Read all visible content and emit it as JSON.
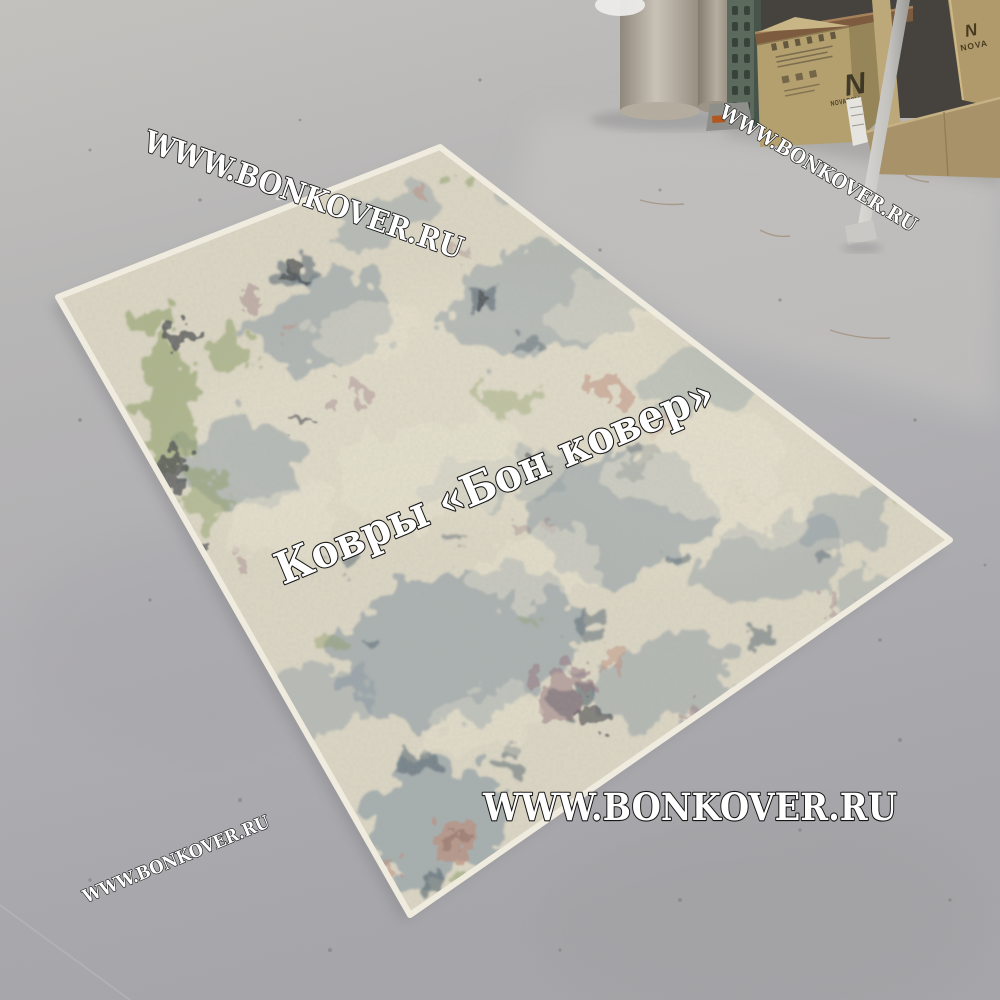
{
  "watermarks": {
    "top_left": "WWW.BONKOVER.RU",
    "top_right": "WWW.BONKOVER.RU",
    "center": "Ковры «Бон ковер»",
    "bottom_center": "WWW.BONKOVER.RU",
    "bottom_left": "WWW.BONKOVER.RU"
  },
  "warehouse": {
    "left_box_logo": "N",
    "left_box_brand": "NOVABOLL",
    "right_box_logo": "N",
    "right_box_brand": "NOVA"
  },
  "colors": {
    "watermark_fill": "#ffffff",
    "watermark_outline": "#151515",
    "floor_grey": "#b3b2b4",
    "rug_base": "#ddd7c4",
    "rug_binding": "#f0ebdf",
    "rug_slate": "#8494a0",
    "rug_navy": "#4e5f6b",
    "rug_green": "#87995c",
    "rug_rose": "#96707a",
    "rug_salmon": "#c08a76",
    "rug_charcoal": "#45464a",
    "rug_worn_ivory": "#eae4d0",
    "carton": "#b4a06f"
  }
}
